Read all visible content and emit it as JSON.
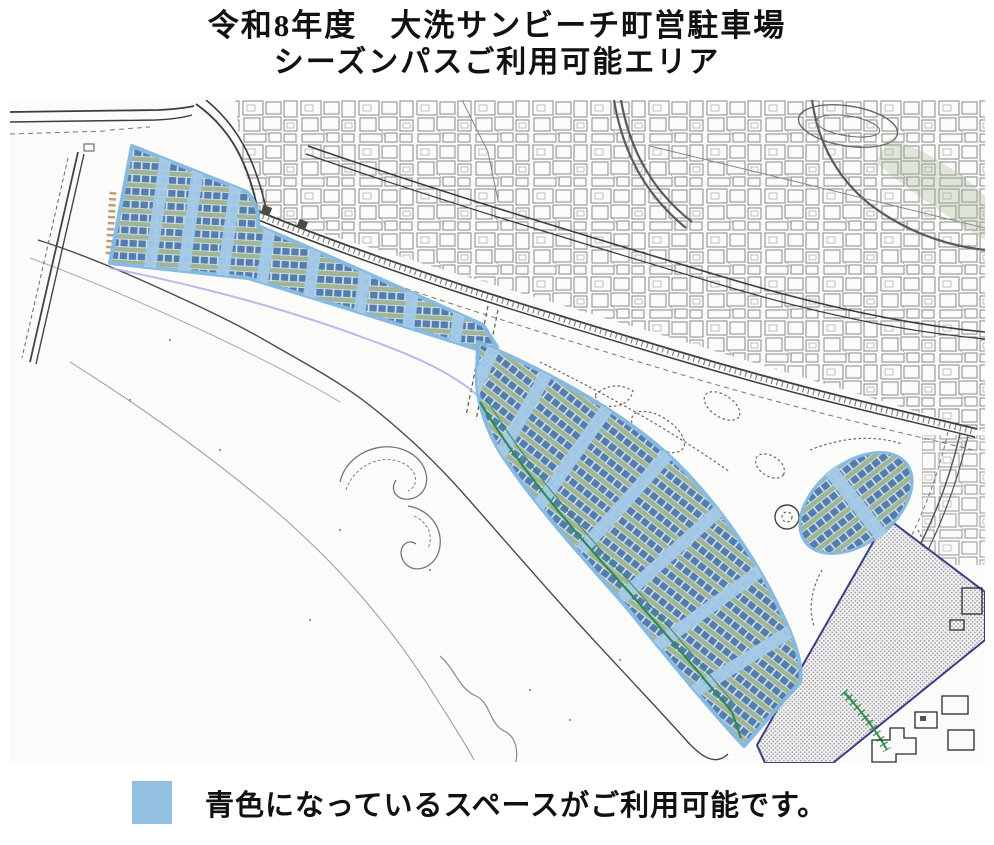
{
  "title": {
    "line1": "令和8年度　大洗サンビーチ町営駐車場",
    "line2": "シーズンパスご利用可能エリア"
  },
  "legend": {
    "swatch_color": "#93bfe0",
    "text": "青色になっているスペースがご利用可能です。"
  },
  "map_colors": {
    "available_area_blue": "#93bfe0",
    "stall_row_blue": "#4e78aa",
    "lot_base_green": "#9eb390",
    "aisle_light_blue": "#a6cbe8",
    "zone_outline_blue": "#82b8e0",
    "reserved_hatch_border": "#3d3d85",
    "greenway_green": "#2f8c4c",
    "road_gray": "#3c3c3c"
  }
}
